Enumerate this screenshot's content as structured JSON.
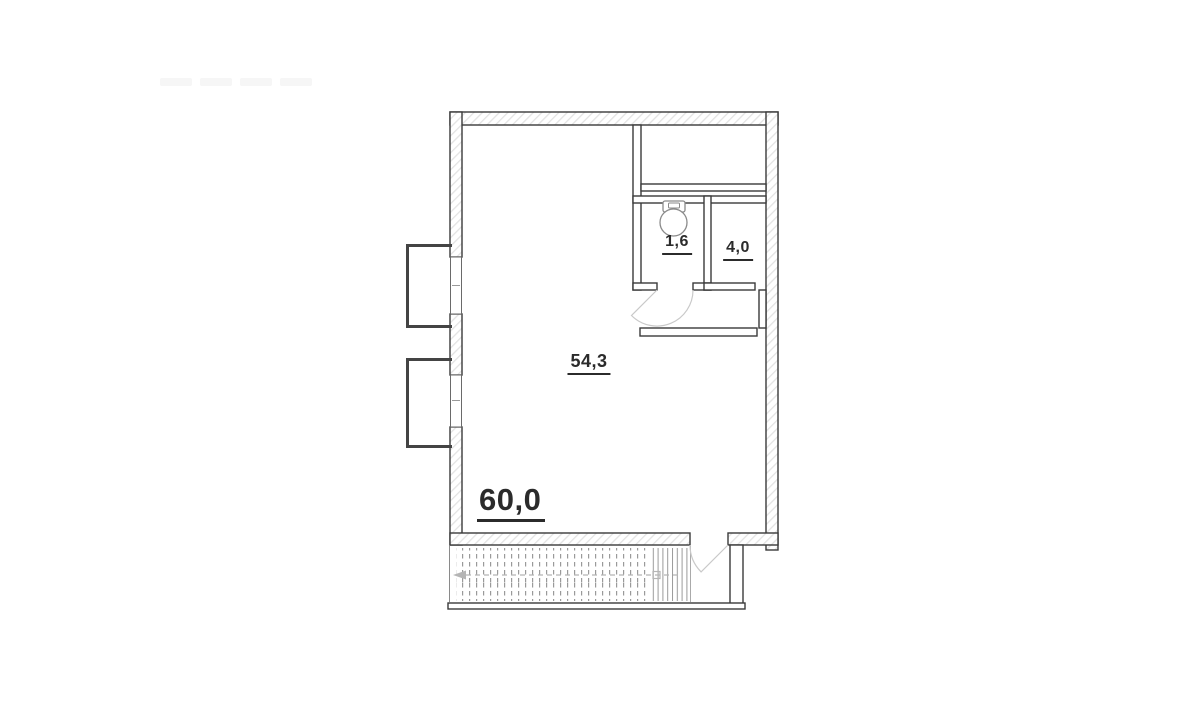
{
  "plan": {
    "kind": "apartment-floor-plan",
    "labels": {
      "total_area": "60,0",
      "living_room": "54,3",
      "wc": "1,6",
      "hall": "4,0"
    },
    "icons": {
      "toilet": "toilet-icon",
      "stairs_direction": "arrow-left-icon"
    },
    "colors": {
      "background": "#ffffff",
      "wall_outline": "#3a3a3a",
      "wall_hatch": "#e3e3e3",
      "text": "#2b2b2b",
      "door_arc": "#c9c9c9",
      "stair_lines": "#9a9a9a",
      "direction_line": "#b5b5b5"
    }
  }
}
